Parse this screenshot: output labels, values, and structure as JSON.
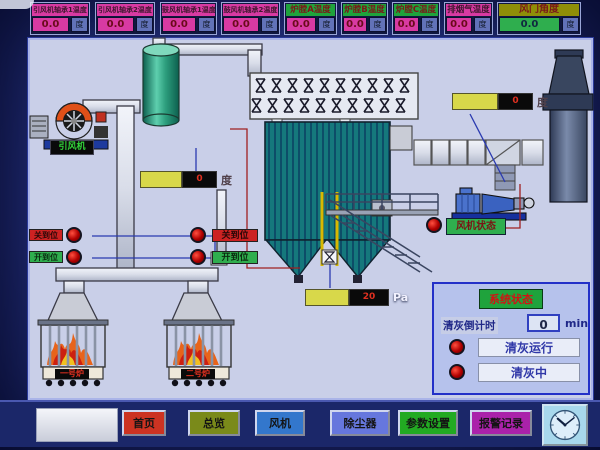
{
  "top_modules": [
    {
      "label": "引风机轴承1温度",
      "value": "0.0",
      "unit": "度"
    },
    {
      "label": "引风机轴承2温度",
      "value": "0.0",
      "unit": "度"
    },
    {
      "label": "鼓风机轴承1温度",
      "value": "0.0",
      "unit": "度"
    },
    {
      "label": "鼓风机轴承2温度",
      "value": "0.0",
      "unit": "度"
    },
    {
      "label": "炉膛A温度",
      "value": "0.0",
      "unit": "度"
    },
    {
      "label": "炉膛B温度",
      "value": "0.0",
      "unit": "度"
    },
    {
      "label": "炉膛C温度",
      "value": "0.0",
      "unit": "度"
    },
    {
      "label": "排烟气温度",
      "value": "0.0",
      "unit": "度"
    },
    {
      "label": "风门角度",
      "value": "0.0",
      "unit": "度"
    }
  ],
  "diagram": {
    "blower_label": "引风机",
    "tank_temp": {
      "value": "0",
      "unit": "度"
    },
    "outlet_temp": {
      "value": "0",
      "unit": "度"
    },
    "pressure": {
      "value": "20",
      "unit": "Pa"
    },
    "left_valve": {
      "closed": "关到位",
      "open": "开到位"
    },
    "right_valve": {
      "closed": "关到位",
      "open": "开到位"
    },
    "fan_status_label": "风机状态",
    "furnace1_label": "一号炉",
    "furnace2_label": "二号炉"
  },
  "status_panel": {
    "title": "系统状态",
    "countdown_label": "清灰倒计时",
    "countdown_value": "0",
    "countdown_unit": "min",
    "indicator1": "清灰运行",
    "indicator2": "清灰中"
  },
  "nav": {
    "home": "首页",
    "overview": "总览",
    "fan": "风机",
    "dust_collector": "除尘器",
    "settings": "参数设置",
    "alarm": "报警记录"
  },
  "colors": {
    "magenta": "#d83aa2",
    "green": "#1fa33c",
    "olive": "#8f8e08",
    "value_green": "#2fae4e",
    "alarm_red": "#cc1111",
    "panel_blue": "#2330c8"
  }
}
